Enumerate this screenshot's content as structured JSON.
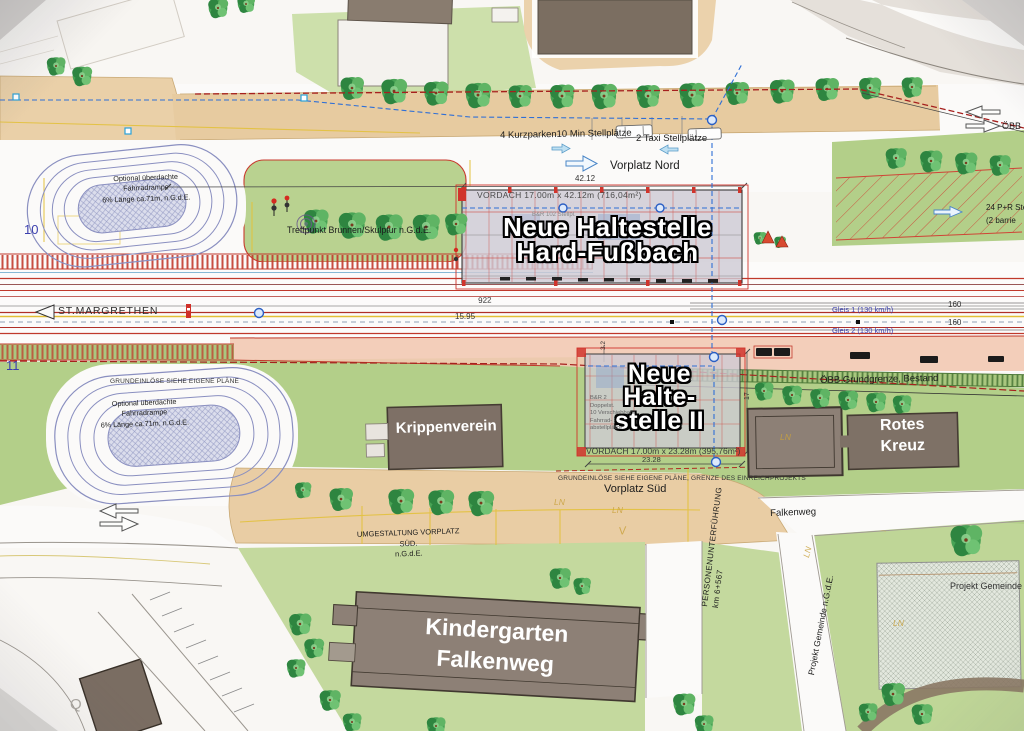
{
  "north": {
    "kurzparken": "4 Kurzparken10 Min Stellplätze",
    "taxi": "2 Taxi Stellplätze",
    "vorplatz_nord": "Vorplatz Nord",
    "dim_42_12": "42.12"
  },
  "station1": {
    "vordach": "VORDACH 17.00m x 42.12m (716,04m²)",
    "name": "Neue Haltestelle\nHard-Fußbach",
    "interior": "B&R 102 Stellpl."
  },
  "station2": {
    "name": "Neue\nHalte-\nstelle II",
    "vordach": "VORDACH 17.00m x 23.28m (395,76m²)",
    "dim_23_28": "23.28",
    "dim_3_2": "3.2",
    "dim_17": "17",
    "interior": "B&R 2\nDoppelst.\n10 Verschiebbare\nFahrrad-\nabstellplätze"
  },
  "ramp_text": "Optional überdachte\nFahrradrampe\n6% Länge ca.71m, n.G.d.E.",
  "rail": {
    "st_margrethen": "ST.MARGRETHEN",
    "dim_922": "922",
    "dim_15_95": "15.95",
    "gleis_1": "Gleis 1  (130 km/h)",
    "gleis_2": "Gleis 2  (130 km/h)",
    "dim_160_a": "160",
    "dim_160_b": "160",
    "obb_grundgrenze": "ÖBB Grundgrenze, Bestand",
    "km_10": "10",
    "km_11": "11"
  },
  "notes": {
    "treffpunkt": "Treffpunkt Brunnen/Skulptur n.G.d.E.",
    "grundeinloese": "GRUNDEINLÖSE SIEHE EIGENE PLÄNE",
    "grundeinloese_grenze": "GRUNDEINLÖSE SIEHE EIGENE PLÄNE, GRENZE DES EINREICHPROJEKTS",
    "umgestaltung": "UMGESTALTUNG VORPLATZ SÜD.\nn.G.d.E.",
    "projekt_gemeinde": "Projekt Gemeinde n.G.d.E.",
    "ln_mark": "LN",
    "v_mark": "V",
    "q_mark": "Q"
  },
  "south": {
    "vorplatz_sued": "Vorplatz Süd",
    "unterfuehrung": "PERSONENUNTERFÜHRUNG\nkm 6+567",
    "falkenweg": "Falkenweg"
  },
  "buildings": {
    "krippenverein": "Krippenverein",
    "rotes_kreuz": "Rotes\nKreuz",
    "kindergarten": "Kindergarten\nFalkenweg"
  },
  "east": {
    "obb_edge": "ÖBB G",
    "pr_stellplaetze": "24 P+R Ste\n(2 barrie"
  },
  "colors": {
    "accent_red": "#c8352b",
    "plan_green": "#b5cf8c",
    "plan_tan": "#e9cfa6",
    "building_brown": "#8d8076",
    "rail_blue": "#3b3fae",
    "tree_green": "#3f9e4f",
    "boundary_blue": "#2f6fd6"
  }
}
